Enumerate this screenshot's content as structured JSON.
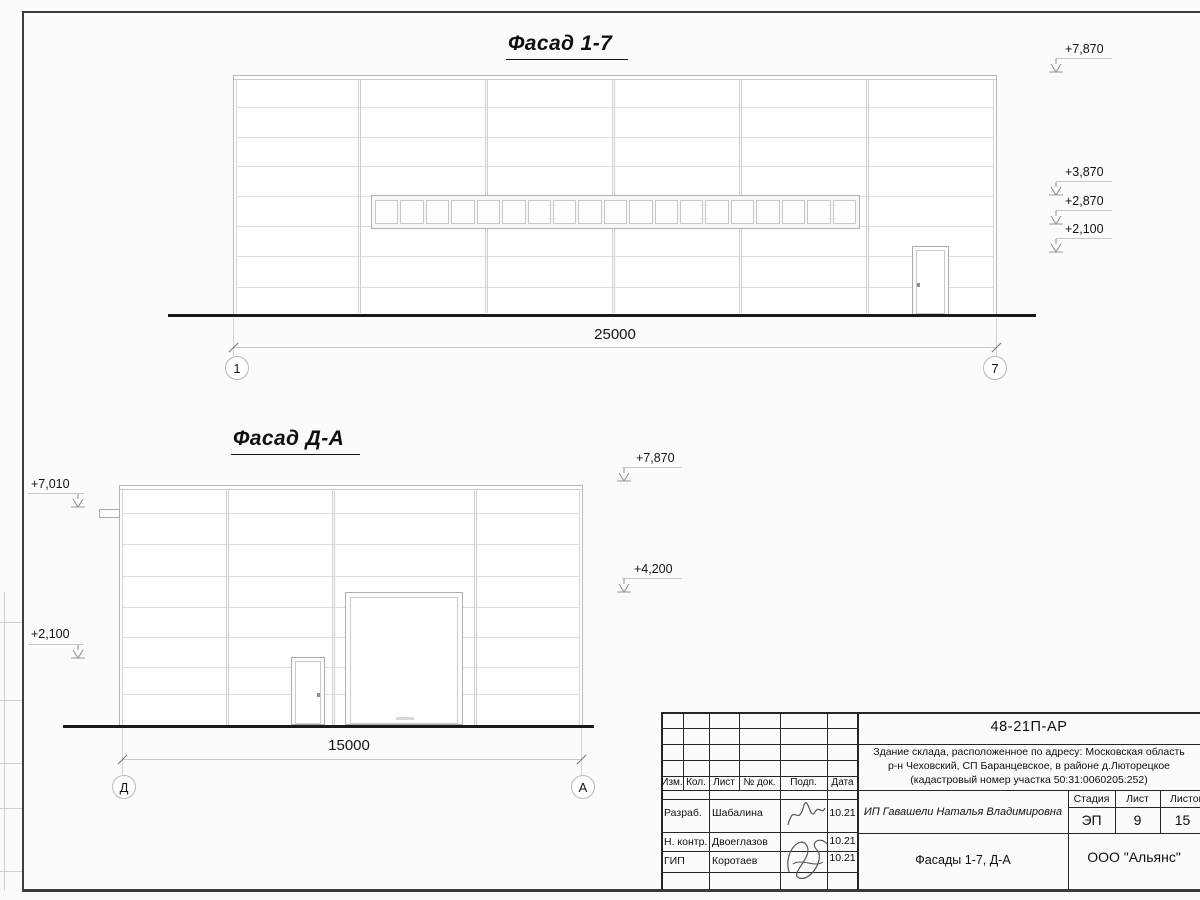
{
  "sheet": {
    "facade_1_7": {
      "title": "Фасад 1-7",
      "dimension": "25000",
      "grid_left": "1",
      "grid_right": "7",
      "elevations_right": [
        "+7,870",
        "+3,870",
        "+2,870",
        "+2,100"
      ]
    },
    "facade_d_a": {
      "title": "Фасад Д-А",
      "dimension": "15000",
      "grid_left": "Д",
      "grid_right": "А",
      "elevations_left": [
        "+7,010",
        "+2,100"
      ],
      "elevations_right": [
        "+7,870",
        "+4,200"
      ]
    },
    "title_block": {
      "doc_number": "48-21П-АР",
      "address_line1": "Здание склада, расположенное по адресу: Московская область",
      "address_line2": "р-н Чеховский, СП Баранцевское, в районе д.Люторецкое",
      "address_line3": "(кадастровый номер участка 50:31:0060205:252)",
      "cols": {
        "izm": "Изм.",
        "kol": "Кол.",
        "list": "Лист",
        "doc": "№ док.",
        "podp": "Подп.",
        "data": "Дата"
      },
      "rows": [
        {
          "role": "Разраб.",
          "name": "Шабалина",
          "date": "10.21"
        },
        {
          "role": "Н. контр.",
          "name": "Двоеглазов",
          "date": "10.21"
        },
        {
          "role": "ГИП",
          "name": "Коротаев",
          "date": "10.21"
        }
      ],
      "client": "ИП Гавашели Наталья Владимировна",
      "stage_label": "Стадия",
      "sheet_label": "Лист",
      "sheets_label": "Листов",
      "stage": "ЭП",
      "sheet_no": "9",
      "sheets_total": "15",
      "drawing_title": "Фасады 1-7, Д-А",
      "company": "ООО \"Альянс\""
    }
  }
}
